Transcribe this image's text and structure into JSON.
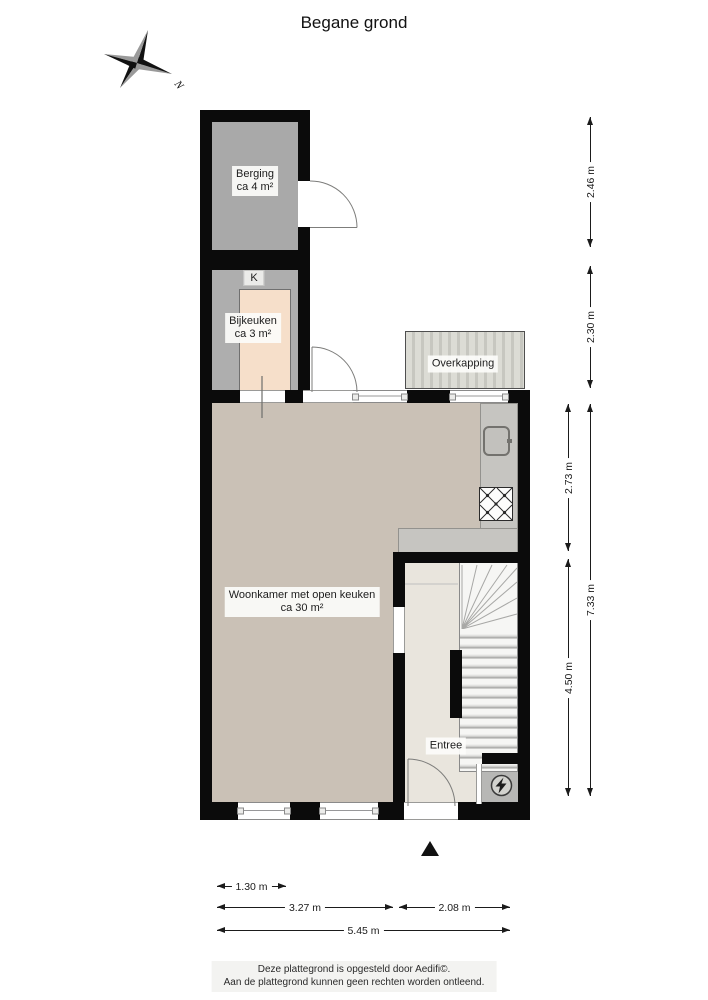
{
  "title": "Begane grond",
  "compass": {
    "north_label": "N"
  },
  "rooms": {
    "berging": {
      "name": "Berging",
      "area": "ca 4 m²"
    },
    "bijkeuken": {
      "name": "Bijkeuken",
      "area": "ca 3 m²",
      "closet_tag": "K"
    },
    "overkapping": {
      "name": "Overkapping"
    },
    "woonkamer": {
      "name": "Woonkamer met open keuken",
      "area": "ca 30 m²"
    },
    "entree": {
      "name": "Entree"
    }
  },
  "dimensions": {
    "right": {
      "d246": "2.46 m",
      "d230": "2.30 m",
      "d273": "2.73 m",
      "d450": "4.50 m",
      "d733": "7.33 m"
    },
    "bottom": {
      "d130": "1.30 m",
      "d327": "3.27 m",
      "d208": "2.08 m",
      "d545": "5.45 m"
    }
  },
  "footer": {
    "line1": "Deze plattegrond is opgesteld door Aedifi©.",
    "line2": "Aan de plattegrond kunnen geen rechten worden ontleend."
  },
  "colors": {
    "wall": "#0b0b0b",
    "berging_floor": "#a9a9a9",
    "bijkeuken_floor": "#f6dfca",
    "woonkamer_floor": "#cac1b6",
    "entree_floor": "#e9e5dd",
    "counter": "#c6c5c1",
    "overkapping": "#dcdcd5"
  }
}
